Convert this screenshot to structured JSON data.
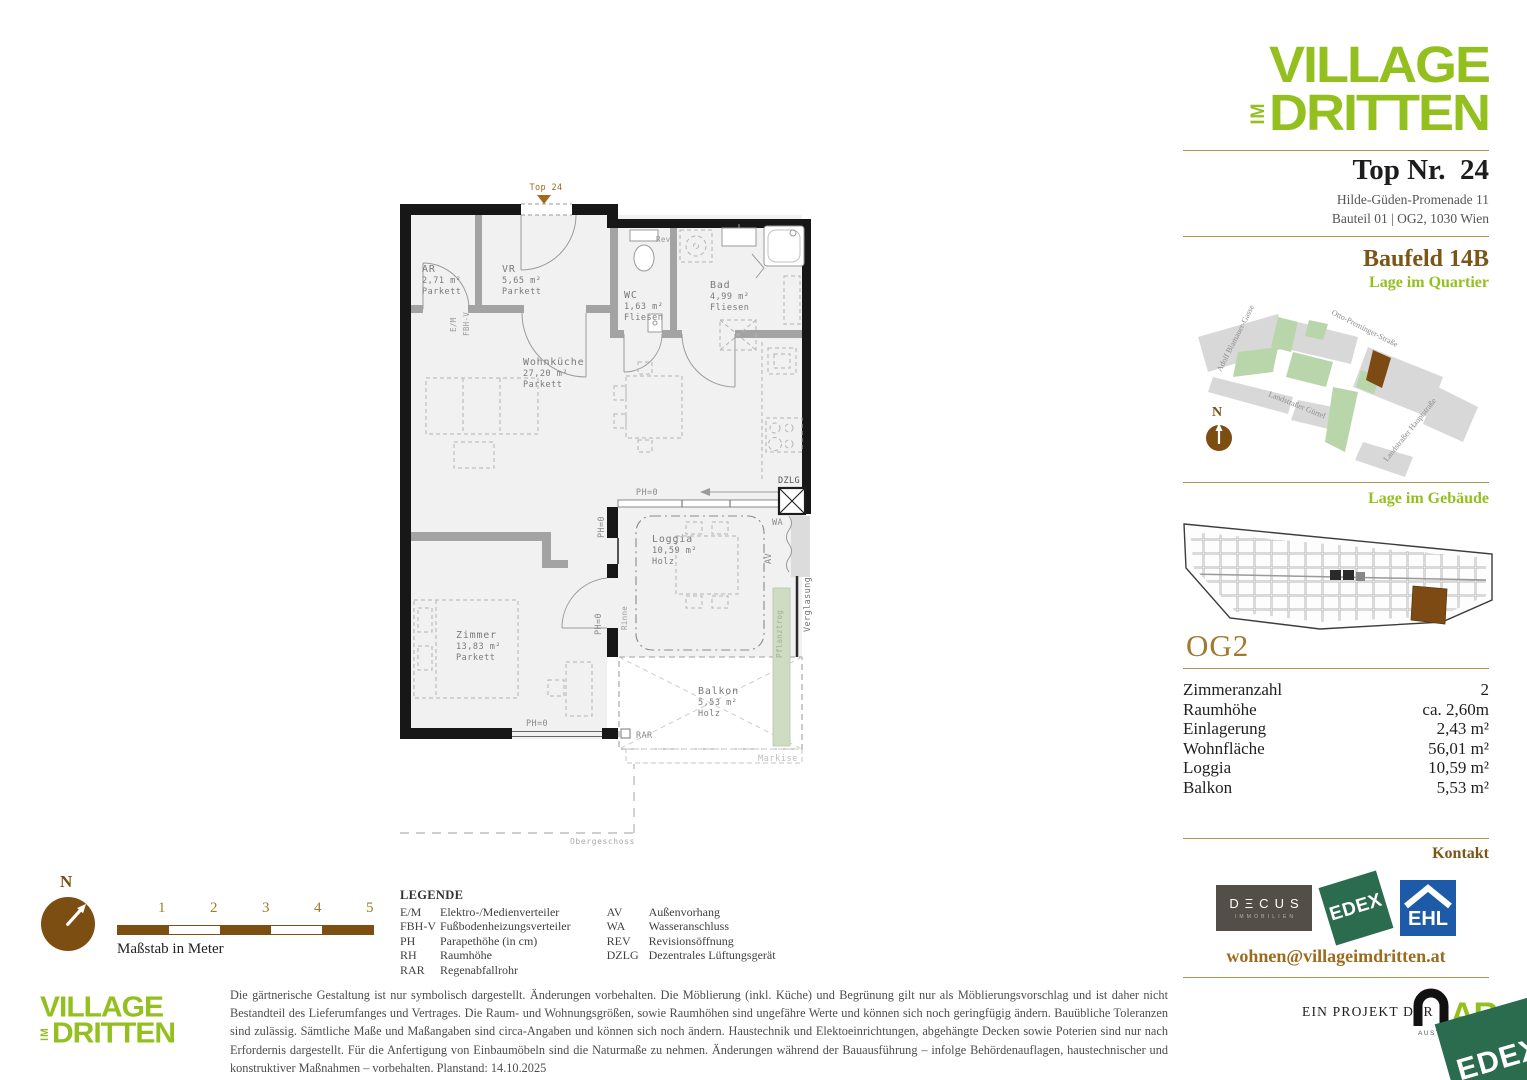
{
  "brand": {
    "word1": "VILLAGE",
    "word2": "IM",
    "word3": "DRITTEN"
  },
  "unit": {
    "title": "Top Nr.  24",
    "address1": "Hilde-Güden-Promenade 11",
    "address2": "Bauteil 01 | OG2, 1030 Wien"
  },
  "quartier": {
    "heading": "Baufeld 14B",
    "subheading": "Lage im Quartier",
    "north": "N",
    "streets": {
      "s1": "Adolf Blamauer-Gasse",
      "s2": "Otto-Preminger-Straße",
      "s3": "Landstraßer Gürtel",
      "s4": "Landstraßer Hauptstraße"
    }
  },
  "gebaeude": {
    "heading": "Lage im Gebäude",
    "floor": "OG2"
  },
  "facts": {
    "rows": [
      {
        "label": "Zimmeranzahl",
        "value": "2"
      },
      {
        "label": "Raumhöhe",
        "value": "ca. 2,60m"
      },
      {
        "label": "Einlagerung",
        "value": "2,43 m²"
      },
      {
        "label": "Wohnfläche",
        "value": "56,01 m²"
      },
      {
        "label": "Loggia",
        "value": "10,59 m²"
      },
      {
        "label": "Balkon",
        "value": "5,53 m²"
      }
    ]
  },
  "kontakt": {
    "heading": "Kontakt",
    "decus_line1": "DΞCUS",
    "decus_line2": "IMMOBILIEN",
    "edex": "EDEX",
    "ehl": "EHL",
    "email": "wohnen@villageimdritten.at"
  },
  "plan": {
    "top_label": "Top 24",
    "ph0": "PH=0",
    "rooms": [
      {
        "name": "AR",
        "area": "2,71 m²",
        "floor": "Parkett"
      },
      {
        "name": "VR",
        "area": "5,65 m²",
        "floor": "Parkett"
      },
      {
        "name": "WC",
        "area": "1,63 m²",
        "floor": "Fliesen"
      },
      {
        "name": "Bad",
        "area": "4,99 m²",
        "floor": "Fliesen"
      },
      {
        "name": "Wohnküche",
        "area": "27,20 m²",
        "floor": "Parkett"
      },
      {
        "name": "Zimmer",
        "area": "13,83 m²",
        "floor": "Parkett"
      },
      {
        "name": "Loggia",
        "area": "10,59 m²",
        "floor": "Holz"
      },
      {
        "name": "Balkon",
        "area": "5,53 m²",
        "floor": "Holz"
      }
    ],
    "ann": {
      "dzlg": "DZLG",
      "wa": "WA",
      "av": "AV",
      "rev": "Rev",
      "em": "E/M",
      "fbhv": "FBH-V",
      "rinne": "Rinne",
      "rar": "RAR",
      "markise": "Markise",
      "pflanztrog": "Pflanztrog",
      "verglasung": "Verglasung",
      "obergeschoss": "Obergeschoss"
    }
  },
  "legend": {
    "title": "LEGENDE",
    "col1": [
      {
        "term": "E/M",
        "def": "Elektro-/Medienverteiler"
      },
      {
        "term": "FBH-V",
        "def": "Fußbodenheizungsverteiler"
      },
      {
        "term": "PH",
        "def": "Parapethöhe (in cm)"
      },
      {
        "term": "RH",
        "def": "Raumhöhe"
      },
      {
        "term": "RAR",
        "def": "Regenabfallrohr"
      }
    ],
    "col2": [
      {
        "term": "AV",
        "def": "Außenvorhang"
      },
      {
        "term": "WA",
        "def": "Wasseranschluss"
      },
      {
        "term": "REV",
        "def": "Revisionsöffnung"
      },
      {
        "term": "DZLG",
        "def": "Dezentrales Lüftungsgerät"
      }
    ]
  },
  "scalebar": {
    "n": "N",
    "numbers": [
      "1",
      "2",
      "3",
      "4",
      "5"
    ],
    "caption": "Maßstab in Meter"
  },
  "footer": {
    "disclaimer": "Die gärtnerische Gestaltung ist nur symbolisch dargestellt. Änderungen vorbehalten. Die Möblierung (inkl. Küche) und Begrünung gilt nur als Möblierungsvorschlag und ist daher nicht Bestandteil des Lieferumfanges und Vertrages. Die Raum- und Wohnungsgrößen, sowie Raumhöhen sind ungefähre Werte und können sich noch geringfügig ändern. Bauübliche Toleranzen sind zulässig. Sämtliche Maße und Maßangaben sind circa-Angaben und können sich noch ändern. Haustechnik und Elektoeinrichtungen, abgehängte Decken sowie Poterien sind nur nach Erfordernis dargestellt. Für die Anfertigung von Einbaumöbeln sind die Naturmaße zu nehmen. Änderungen während der Bauausführung – infolge Behördenauflagen, haustechnischer und konstruktiver Maßnahmen – vorbehalten. Planstand: 14.10.2025",
    "project": "EIN PROJEKT DER",
    "are": "ARE",
    "are_sub": "AUSTRIAN REA",
    "edex": "EDEX"
  }
}
